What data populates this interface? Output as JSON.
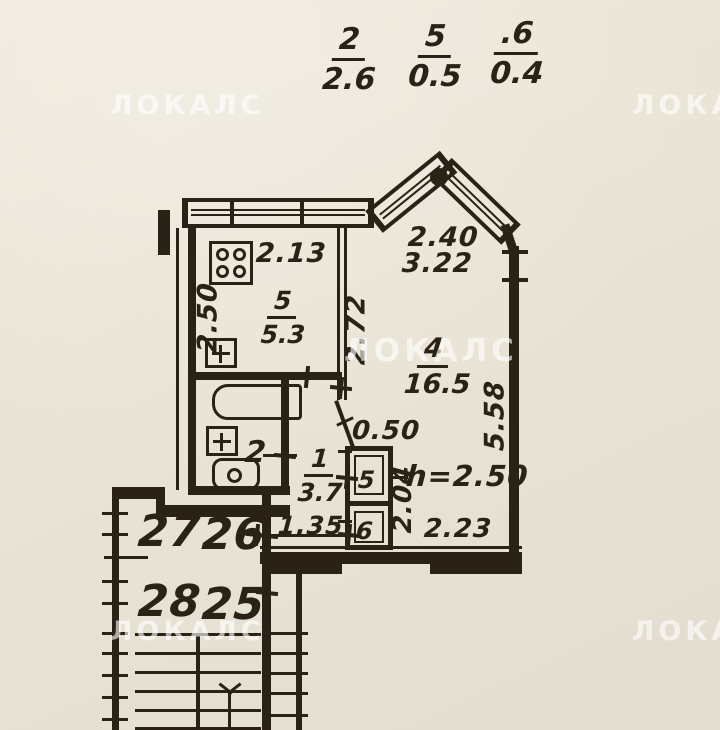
{
  "header": {
    "fractions": [
      {
        "num": "2",
        "den": "2.6"
      },
      {
        "num": "5",
        "den": "0.5"
      },
      {
        "num": ".6",
        "den": "0.4"
      }
    ]
  },
  "watermark": {
    "text": "ЛОКАЛС"
  },
  "plan": {
    "kitchen": {
      "number": "5",
      "area": "5.3",
      "width": "2.13",
      "depth": "2.50"
    },
    "room": {
      "number": "4",
      "area": "16.5",
      "side": "2.72",
      "right_side": "5.58",
      "bottom": "2.23",
      "height": "h=2.50"
    },
    "bay": {
      "width": "2.40",
      "length": "3.22"
    },
    "bathroom": {
      "number": "2"
    },
    "hall": {
      "number": "1",
      "area": "3.7",
      "width": "1.35"
    },
    "niche": {
      "width": "0.50",
      "depth": "2.04"
    },
    "closets": {
      "upper": "5",
      "lower": "6"
    },
    "stair": {
      "apartments": [
        "27",
        "26",
        "28",
        "25"
      ]
    }
  },
  "colors": {
    "paper": "#eae4d6",
    "ink": "#2b2217",
    "watermark": "rgba(255,255,255,0.62)"
  }
}
